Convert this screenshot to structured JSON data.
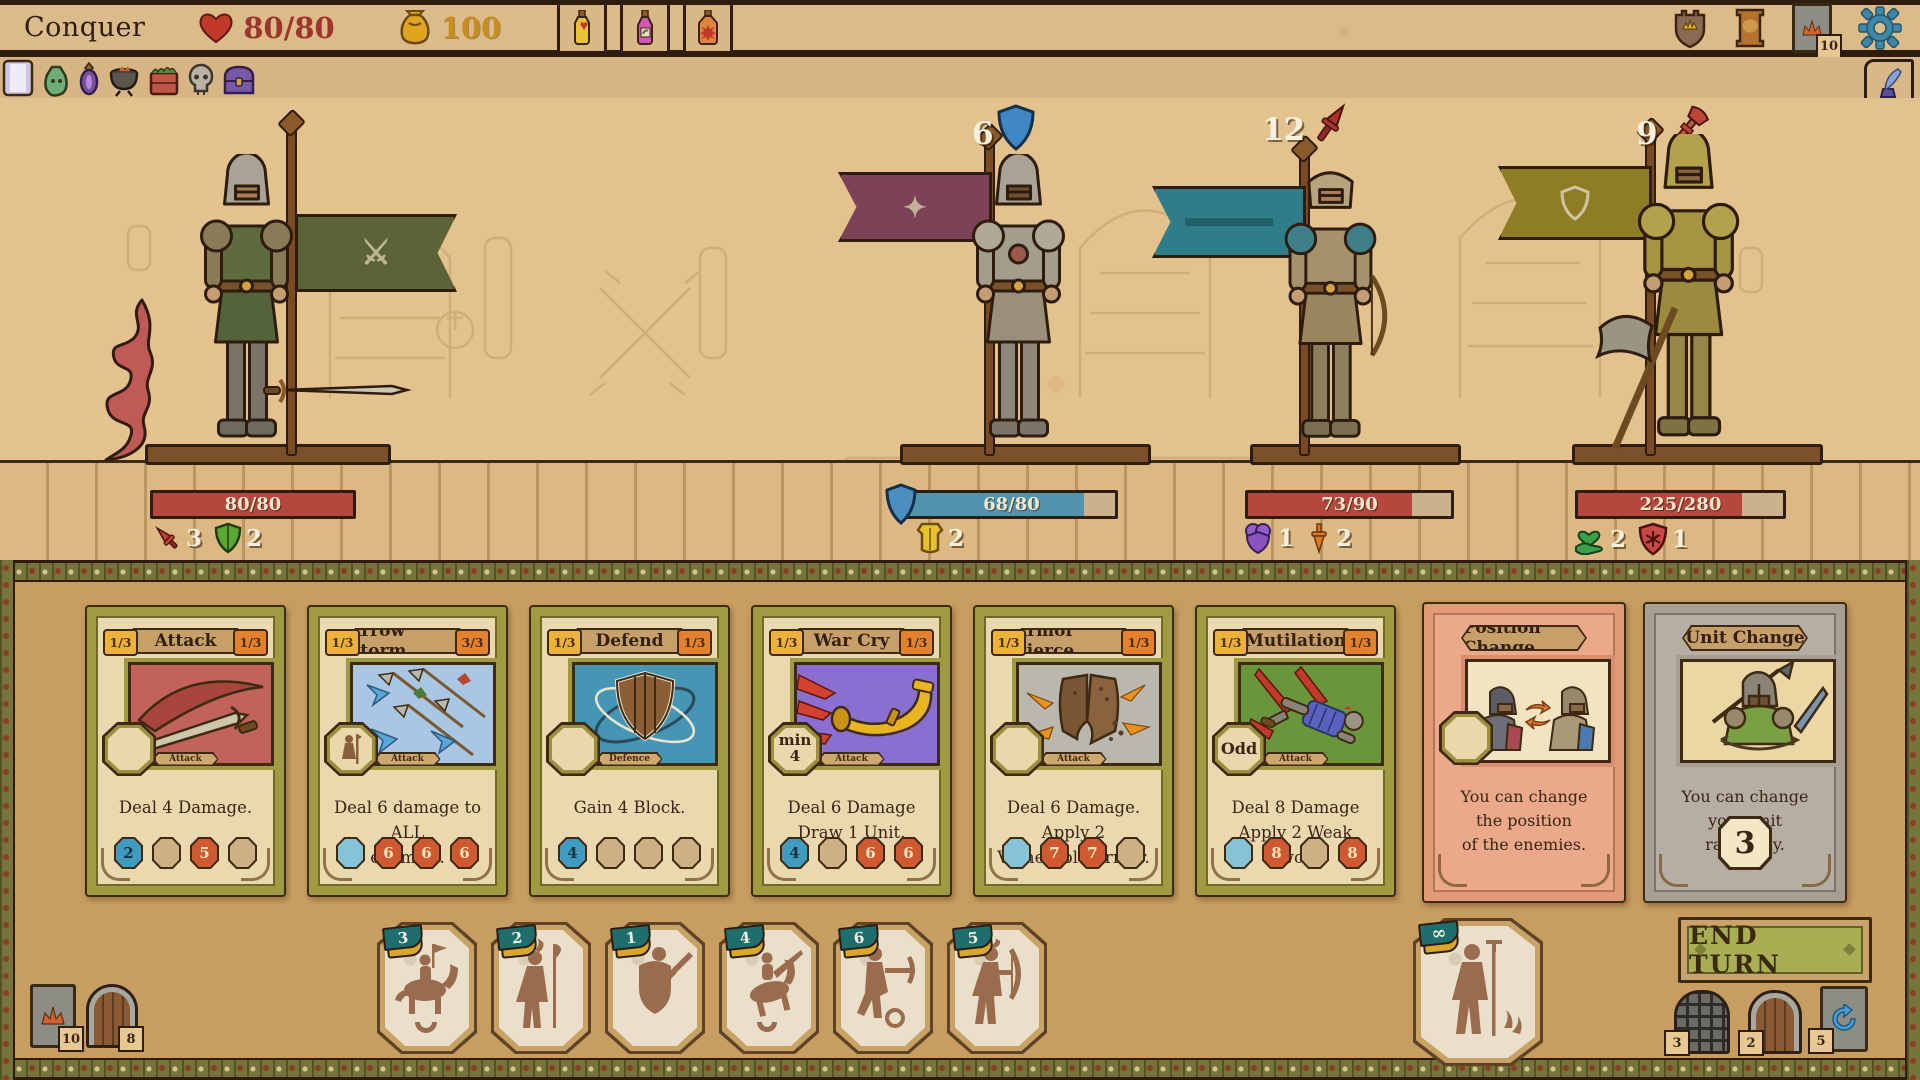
{
  "palette": {
    "parchment": "#e2c28e",
    "dark_brown": "#2e1d0e",
    "hand_bg": "#c79d60",
    "card_border": "#a09b41",
    "chip_blue": "#3f9cc0",
    "chip_red": "#cf5a31",
    "hp_red": "#b5473c",
    "hp_blue": "#4f93ad",
    "gold": "#c78e1c",
    "gear_blue": "#3f87a6",
    "end_turn_green": "#a9ae55",
    "salmon": "#eba98a",
    "gray": "#b7aea3",
    "flag_green": "#5c6337",
    "flag_maroon": "#7c4257",
    "flag_teal": "#2f7d88",
    "flag_olive": "#8f7d26"
  },
  "header": {
    "title": "Conquer",
    "hp": {
      "icon": "heart-icon",
      "value": "80/80"
    },
    "gold": {
      "icon": "gold-pouch-icon",
      "value": "100"
    },
    "potions": [
      {
        "name": "health-potion"
      },
      {
        "name": "magic-potion"
      },
      {
        "name": "explosive-potion"
      }
    ],
    "right_icons": [
      {
        "name": "kingdom-shield"
      },
      {
        "name": "map-scroll"
      },
      {
        "name": "deck",
        "badge": "10"
      },
      {
        "name": "settings-gear"
      }
    ]
  },
  "utility_bar": {
    "items": [
      "journal",
      "loot-bag",
      "amulet",
      "cauldron",
      "supply-crate",
      "skull",
      "treasure-chest"
    ],
    "quill": "quill-ink"
  },
  "battle": {
    "units": [
      {
        "name": "swordsman",
        "hp": "80/80",
        "hp_pct": 100,
        "bar": "red",
        "statuses": [
          {
            "icon": "sword-red-icon",
            "value": "3"
          },
          {
            "icon": "shield-green-icon",
            "value": "2"
          }
        ]
      },
      {
        "name": "plate-knight",
        "hp": "68/80",
        "hp_pct": 85,
        "bar": "blue",
        "block_badge": {
          "icon": "shield-blue-icon",
          "value": "6"
        },
        "statuses": [
          {
            "icon": "armor-yellow-icon",
            "value": "2"
          }
        ]
      },
      {
        "name": "archer-knight",
        "hp": "73/90",
        "hp_pct": 81,
        "bar": "red",
        "block_badge": {
          "icon": "dagger-red-icon",
          "value": "12"
        },
        "statuses": [
          {
            "icon": "shield-purple-icon",
            "value": "1"
          },
          {
            "icon": "dagger-orange-icon",
            "value": "2"
          }
        ]
      },
      {
        "name": "axe-knight",
        "hp": "225/280",
        "hp_pct": 80,
        "bar": "red",
        "block_badge": {
          "icon": "axe-red-icon",
          "value": "9"
        },
        "statuses": [
          {
            "icon": "hand-heart-green-icon",
            "value": "2"
          },
          {
            "icon": "shield-red-star-icon",
            "value": "1"
          }
        ]
      }
    ]
  },
  "hand": {
    "cards": [
      {
        "title": "Attack",
        "left_badge": "1/3",
        "right_badge": "1/3",
        "type": "Attack",
        "slot": "",
        "desc": "Deal 4 Damage.",
        "chips": [
          {
            "style": "blue",
            "value": "2"
          },
          {
            "style": "tan",
            "value": ""
          },
          {
            "style": "red",
            "value": "5"
          },
          {
            "style": "tan",
            "value": ""
          }
        ]
      },
      {
        "title": "Arrow Storm",
        "left_badge": "1/3",
        "right_badge": "3/3",
        "type": "Attack",
        "slot": "",
        "desc": "Deal 6 damage to ALL\nenemies.",
        "chips": [
          {
            "style": "lightblue",
            "value": ""
          },
          {
            "style": "red",
            "value": "6"
          },
          {
            "style": "red",
            "value": "6"
          },
          {
            "style": "red",
            "value": "6"
          }
        ]
      },
      {
        "title": "Defend",
        "left_badge": "1/3",
        "right_badge": "1/3",
        "type": "Defence",
        "slot": "",
        "desc": "Gain 4 Block.",
        "chips": [
          {
            "style": "blue",
            "value": "4"
          },
          {
            "style": "tan",
            "value": ""
          },
          {
            "style": "tan",
            "value": ""
          },
          {
            "style": "tan",
            "value": ""
          }
        ]
      },
      {
        "title": "War Cry",
        "left_badge": "1/3",
        "right_badge": "1/3",
        "type": "Attack",
        "slot": "min\n4",
        "desc": "Deal 6 Damage\nDraw 1 Unit.",
        "chips": [
          {
            "style": "blue",
            "value": "4"
          },
          {
            "style": "tan",
            "value": ""
          },
          {
            "style": "red",
            "value": "6"
          },
          {
            "style": "red",
            "value": "6"
          }
        ]
      },
      {
        "title": "Armor Pierce",
        "left_badge": "1/3",
        "right_badge": "1/3",
        "type": "Attack",
        "slot": "",
        "desc": "Deal 6 Damage.\nApply 2 Vulnerable Armor.",
        "chips": [
          {
            "style": "lightblue",
            "value": ""
          },
          {
            "style": "red",
            "value": "7"
          },
          {
            "style": "red",
            "value": "7"
          },
          {
            "style": "tan",
            "value": ""
          }
        ]
      },
      {
        "title": "Mutilation",
        "left_badge": "1/3",
        "right_badge": "1/3",
        "type": "Attack",
        "slot": "Odd",
        "desc": "Deal 8 Damage\nApply 2 Weak Sword",
        "chips": [
          {
            "style": "lightblue",
            "value": ""
          },
          {
            "style": "red",
            "value": "8"
          },
          {
            "style": "tan",
            "value": ""
          },
          {
            "style": "red",
            "value": "8"
          }
        ]
      }
    ],
    "special": [
      {
        "title": "Position Change",
        "desc": "You can change the position\nof the enemies."
      },
      {
        "title": "Unit Change",
        "desc": "You can change your unit\nrandomly.",
        "counter": "3"
      }
    ]
  },
  "tokens": {
    "units": [
      {
        "count": "3",
        "type": "cavalry"
      },
      {
        "count": "2",
        "type": "halberdier"
      },
      {
        "count": "1",
        "type": "swordsman"
      },
      {
        "count": "4",
        "type": "lancer"
      },
      {
        "count": "6",
        "type": "crossbowman"
      },
      {
        "count": "5",
        "type": "archer"
      }
    ],
    "peasant": {
      "count": "∞",
      "type": "peasant"
    }
  },
  "footer": {
    "end_turn": "END TURN",
    "deck_counter": "10",
    "discard_door": "8",
    "gate_counter": "3",
    "door_counter": "2",
    "redraw_counter": "5"
  }
}
